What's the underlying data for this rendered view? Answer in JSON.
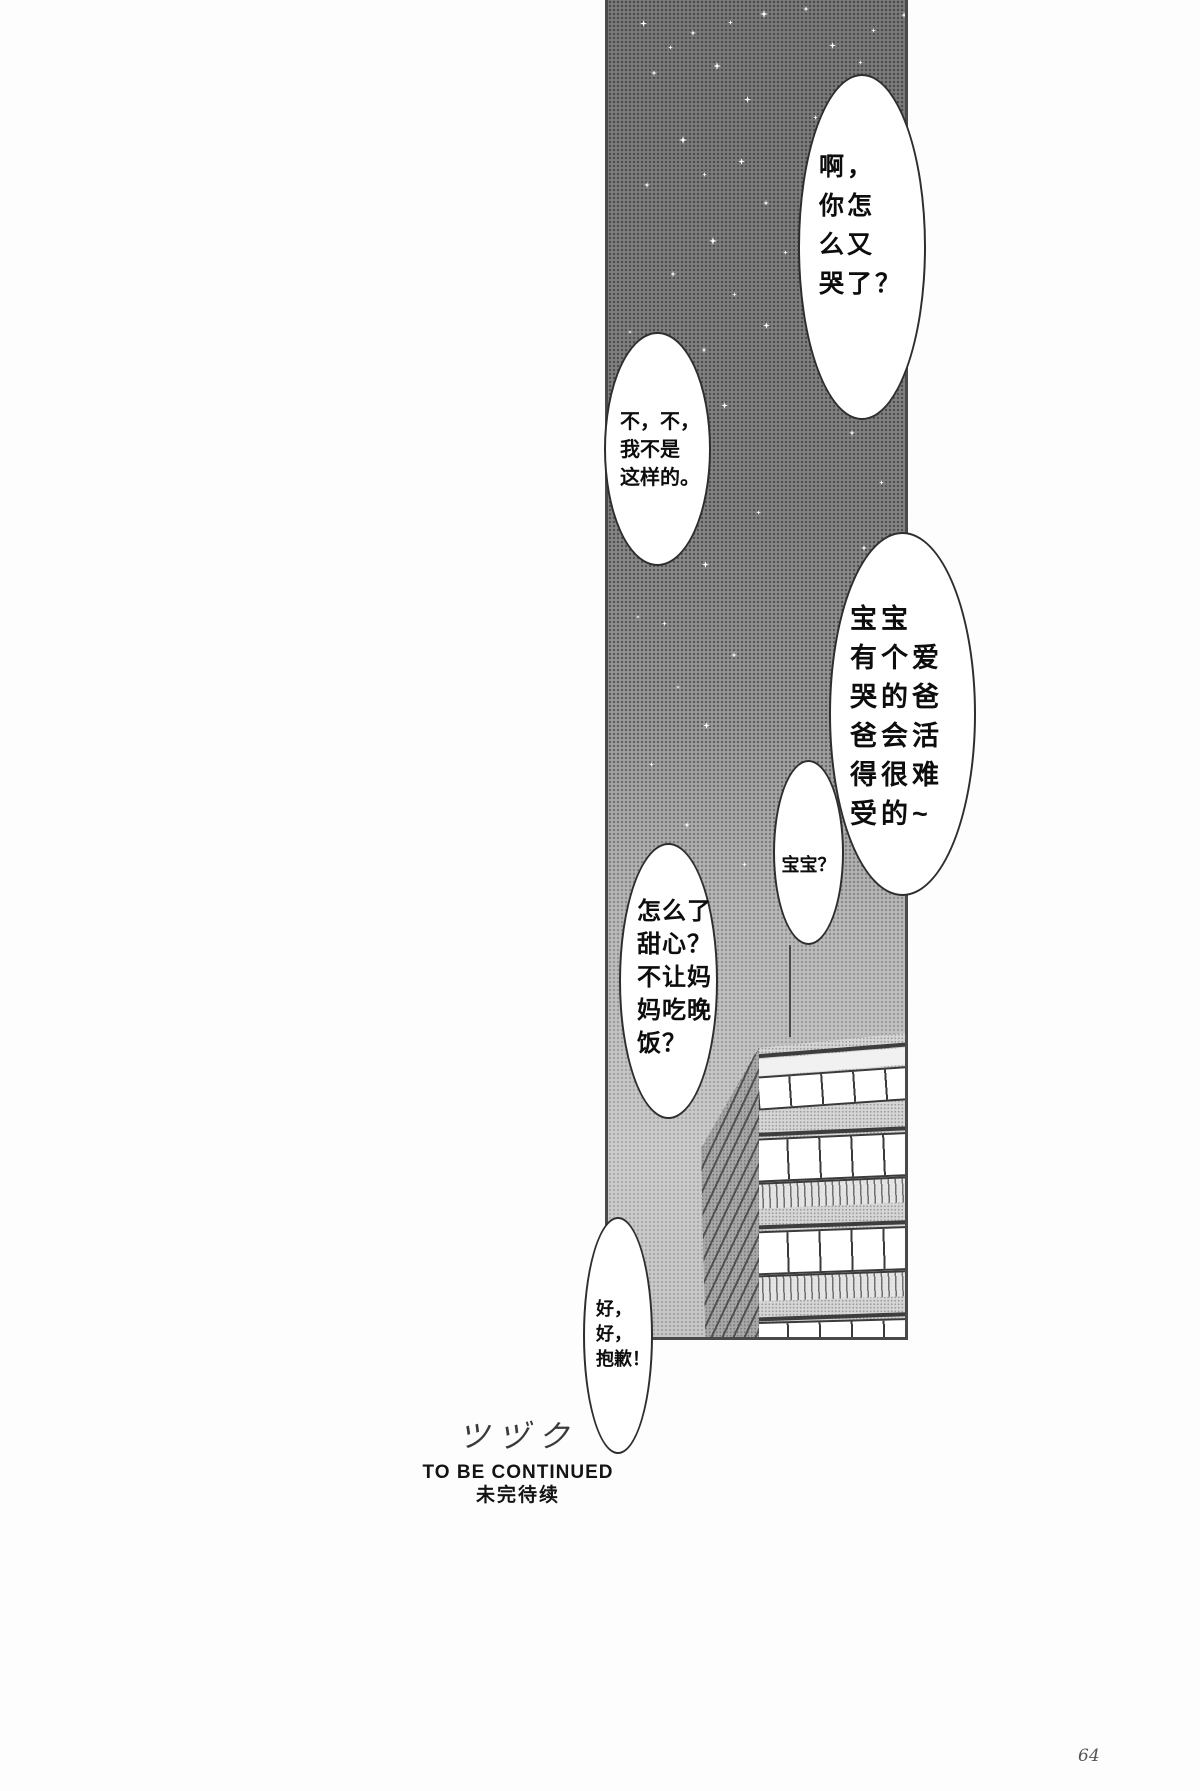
{
  "page": {
    "number": "64"
  },
  "panel": {
    "sky_color": "#9a9a9a",
    "dot_color": "#5c5c5c",
    "border_color": "#4a4a4a"
  },
  "bubbles": {
    "cry": {
      "text": "啊，\n你怎\n么又\n哭了？"
    },
    "deny": {
      "text": "不，不，\n我不是\n这样的。"
    },
    "baobao_long": {
      "text": "宝宝\n有个爱\n哭的爸\n爸会活\n得很难\n受的~"
    },
    "baobao": {
      "text": "宝宝？"
    },
    "sweetheart": {
      "text": "怎么了\n甜心？\n不让妈\n妈吃晚\n饭？"
    },
    "sorry": {
      "text": "好，\n好，\n抱歉！"
    }
  },
  "footer": {
    "tsuzuku": "ツヅク",
    "to_be_continued": "TO BE CONTINUED",
    "weiwandaixu": "未完待续"
  },
  "stars": [
    [
      32,
      20,
      7
    ],
    [
      82,
      30,
      6
    ],
    [
      152,
      10,
      8
    ],
    [
      195,
      6,
      6
    ],
    [
      221,
      42,
      7
    ],
    [
      263,
      28,
      5
    ],
    [
      293,
      12,
      6
    ],
    [
      43,
      70,
      6
    ],
    [
      105,
      62,
      8
    ],
    [
      136,
      96,
      7
    ],
    [
      60,
      45,
      5
    ],
    [
      120,
      20,
      5
    ],
    [
      250,
      60,
      5
    ],
    [
      205,
      115,
      5
    ],
    [
      71,
      136,
      8
    ],
    [
      36,
      182,
      6
    ],
    [
      94,
      172,
      5
    ],
    [
      130,
      158,
      7
    ],
    [
      155,
      200,
      6
    ],
    [
      101,
      237,
      8
    ],
    [
      62,
      271,
      6
    ],
    [
      124,
      292,
      5
    ],
    [
      20,
      330,
      4
    ],
    [
      175,
      250,
      5
    ],
    [
      155,
      322,
      7
    ],
    [
      93,
      347,
      6
    ],
    [
      230,
      330,
      5
    ],
    [
      43,
      382,
      5
    ],
    [
      113,
      402,
      7
    ],
    [
      73,
      442,
      6
    ],
    [
      241,
      430,
      6
    ],
    [
      271,
      480,
      5
    ],
    [
      148,
      510,
      5
    ],
    [
      253,
      545,
      6
    ],
    [
      35,
      520,
      6
    ],
    [
      94,
      561,
      7
    ],
    [
      54,
      621,
      5
    ],
    [
      28,
      615,
      4
    ],
    [
      123,
      652,
      6
    ],
    [
      95,
      722,
      7
    ],
    [
      68,
      685,
      4
    ],
    [
      41,
      762,
      5
    ],
    [
      76,
      822,
      6
    ],
    [
      134,
      862,
      5
    ],
    [
      99,
      932,
      6
    ],
    [
      51,
      982,
      5
    ]
  ]
}
